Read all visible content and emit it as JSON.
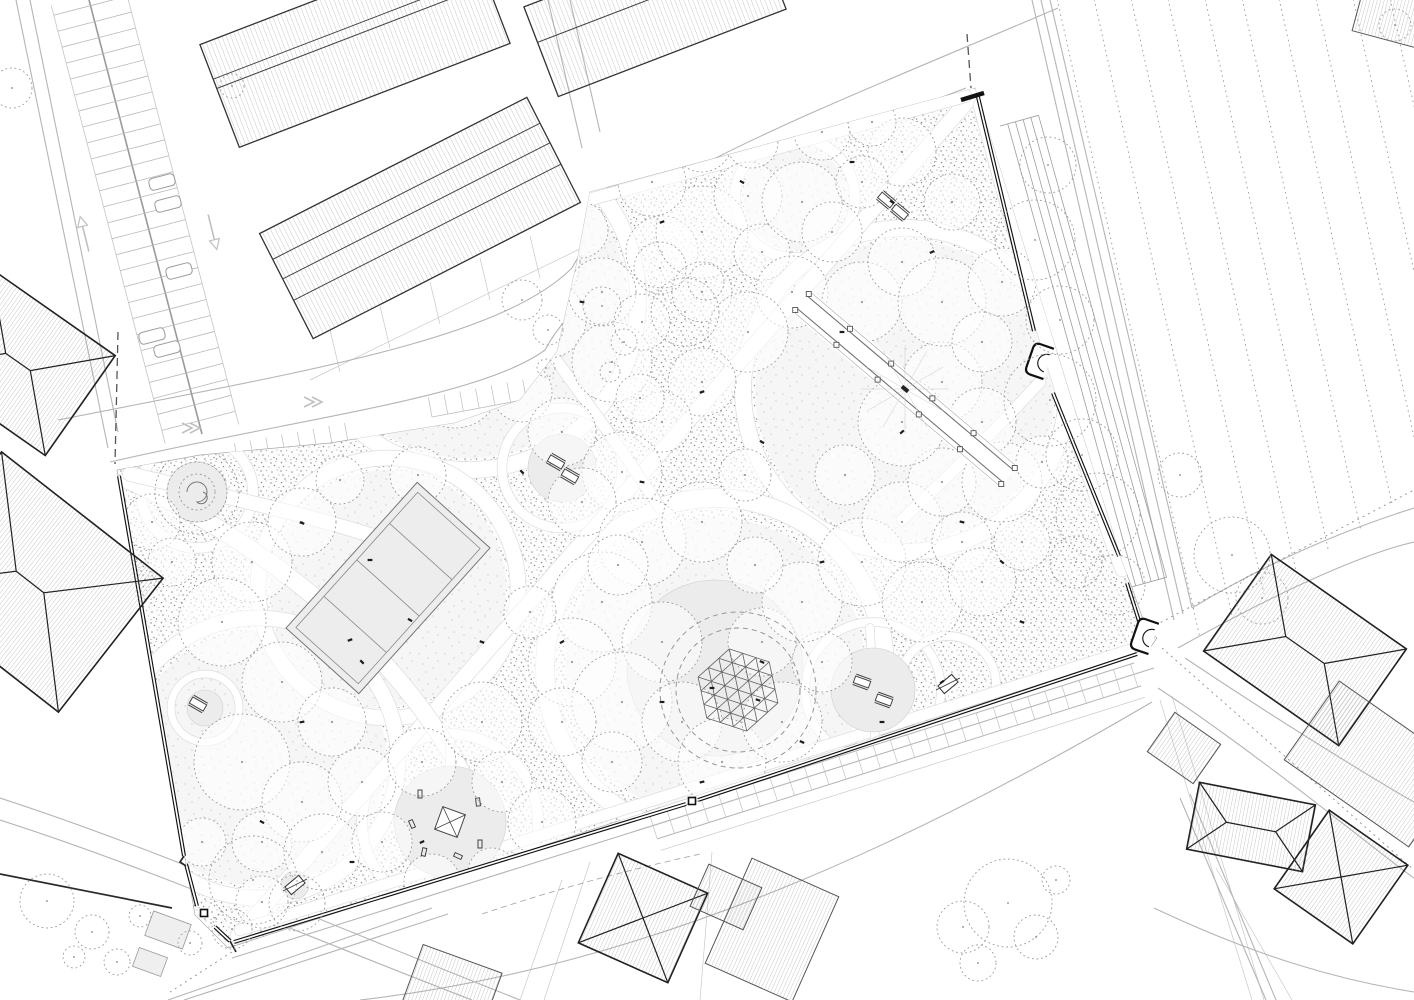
{
  "drawing": {
    "kind": "landscape-site-plan",
    "width": 1414,
    "height": 1000
  },
  "palette": {
    "ink": "#1a1a1a",
    "line": "#8a8a8a",
    "faint": "#c9c9c9",
    "road": "#b5b5b5",
    "stipple_dot": "#8c8c8c",
    "stipple_dot_light": "#b9b9b9",
    "clearing": "#f6f6f6",
    "lawn": "#ececec",
    "court": "#ededed",
    "white": "#ffffff",
    "wall": "#111111",
    "roof_hatch": "#8f8f8f",
    "tree": "#909090"
  },
  "park": {
    "boundary": [
      [
        590,
        192
      ],
      [
        975,
        88
      ],
      [
        1122,
        562
      ],
      [
        1131,
        585
      ],
      [
        1146,
        628
      ],
      [
        1157,
        638
      ],
      [
        1150,
        648
      ],
      [
        228,
        948
      ],
      [
        195,
        915
      ],
      [
        117,
        470
      ],
      [
        200,
        455
      ],
      [
        330,
        443
      ],
      [
        455,
        423
      ],
      [
        520,
        400
      ],
      [
        557,
        352
      ],
      [
        577,
        262
      ]
    ],
    "walls": [
      "M 978,97 L 1034,331",
      "M 1053,393 L 1119,556",
      "M 1127,583 L 1139,621",
      "M 1137,654 L 698,800",
      "M 686,804 L 234,942",
      "M 119,476 L 184,856",
      "M 186,864 L 197,906",
      "M 215,927 L 230,941"
    ],
    "thin_walls": [
      "M 0,874 L 172,908",
      "M 230,941 L 236,952",
      "M 184,856 L 180,862 L 186,866"
    ],
    "gate_bar": "M 961,100 L 984,93",
    "pillars": [
      [
        204,
        913
      ],
      [
        692,
        801
      ]
    ],
    "alcoves": [
      [
        1043,
        362,
        -71
      ],
      [
        1148,
        637,
        -71
      ]
    ]
  },
  "clearings": [
    [
      468,
      300,
      158
    ],
    [
      795,
      198,
      52
    ],
    [
      905,
      390,
      150
    ],
    [
      388,
      588,
      118
    ],
    [
      715,
      668,
      150
    ],
    [
      258,
      758,
      128
    ]
  ],
  "rings": [
    [
      468,
      300,
      170,
      16
    ],
    [
      795,
      198,
      60,
      10
    ],
    [
      905,
      390,
      162,
      16
    ],
    [
      388,
      588,
      130,
      15
    ],
    [
      715,
      668,
      170,
      18
    ],
    [
      258,
      758,
      140,
      15
    ],
    [
      450,
      822,
      88,
      10
    ],
    [
      562,
      468,
      60,
      9
    ],
    [
      873,
      690,
      68,
      8
    ],
    [
      948,
      684,
      48,
      8
    ],
    [
      197,
      492,
      56,
      10
    ],
    [
      205,
      708,
      34,
      7
    ]
  ],
  "lawn_discs": [
    [
      715,
      668,
      88
    ],
    [
      450,
      822,
      56
    ],
    [
      873,
      690,
      42
    ],
    [
      562,
      468,
      34
    ],
    [
      197,
      492,
      30
    ],
    [
      205,
      708,
      18
    ],
    [
      295,
      885,
      14
    ]
  ],
  "paths": [
    {
      "d": "M 238,936 L 972,96",
      "w": 15
    },
    {
      "d": "M 128,480 C 300,560 420,680 470,790 C 496,846 540,868 622,856",
      "w": 17
    },
    {
      "d": "M 130,474 C 240,500 330,520 400,545",
      "w": 14
    },
    {
      "d": "M 980,105 C 1010,220 1070,430 1122,570",
      "w": 13
    },
    {
      "d": "M 240,930 L 1130,650",
      "w": 11
    },
    {
      "d": "M 588,200 L 966,96",
      "w": 12
    },
    {
      "d": "M 556,360 C 600,420 636,470 660,508",
      "w": 11
    },
    {
      "d": "M 1040,382 C 986,440 942,482 902,520",
      "w": 11
    },
    {
      "d": "M 450,742 L 452,940",
      "w": 9
    },
    {
      "d": "M 870,628 L 876,760",
      "w": 8
    },
    {
      "d": "M 700,826 C 760,800 820,770 880,740",
      "w": 9
    }
  ],
  "trees": [
    [
      400,
      240,
      55
    ],
    [
      470,
      215,
      42
    ],
    [
      532,
      262,
      48
    ],
    [
      428,
      302,
      36
    ],
    [
      492,
      322,
      50
    ],
    [
      548,
      320,
      38
    ],
    [
      390,
      348,
      42
    ],
    [
      455,
      382,
      46
    ],
    [
      522,
      392,
      30
    ],
    [
      350,
      300,
      30
    ],
    [
      562,
      432,
      34
    ],
    [
      612,
      362,
      40
    ],
    [
      602,
      292,
      34
    ],
    [
      642,
      322,
      28
    ],
    [
      662,
      252,
      36
    ],
    [
      702,
      232,
      46
    ],
    [
      748,
      196,
      34
    ],
    [
      702,
      292,
      30
    ],
    [
      762,
      252,
      28
    ],
    [
      802,
      202,
      40
    ],
    [
      832,
      232,
      30
    ],
    [
      792,
      292,
      36
    ],
    [
      748,
      332,
      40
    ],
    [
      702,
      382,
      34
    ],
    [
      662,
      422,
      30
    ],
    [
      622,
      472,
      40
    ],
    [
      582,
      502,
      34
    ],
    [
      642,
      542,
      44
    ],
    [
      702,
      522,
      40
    ],
    [
      602,
      602,
      50
    ],
    [
      662,
      642,
      40
    ],
    [
      572,
      662,
      44
    ],
    [
      622,
      702,
      50
    ],
    [
      682,
      722,
      40
    ],
    [
      562,
      722,
      34
    ],
    [
      612,
      762,
      30
    ],
    [
      722,
      762,
      44
    ],
    [
      782,
      722,
      40
    ],
    [
      762,
      642,
      34
    ],
    [
      822,
      662,
      30
    ],
    [
      802,
      602,
      40
    ],
    [
      862,
      562,
      44
    ],
    [
      902,
      522,
      40
    ],
    [
      942,
      482,
      34
    ],
    [
      962,
      542,
      30
    ],
    [
      922,
      602,
      40
    ],
    [
      982,
      582,
      34
    ],
    [
      1022,
      542,
      28
    ],
    [
      1002,
      482,
      40
    ],
    [
      1042,
      462,
      26
    ],
    [
      902,
      422,
      44
    ],
    [
      942,
      382,
      40
    ],
    [
      982,
      422,
      34
    ],
    [
      862,
      302,
      40
    ],
    [
      902,
      262,
      34
    ],
    [
      942,
      302,
      44
    ],
    [
      982,
      342,
      30
    ],
    [
      1002,
      282,
      34
    ],
    [
      952,
      202,
      28
    ],
    [
      902,
      152,
      34
    ],
    [
      862,
      182,
      26
    ],
    [
      252,
      562,
      40
    ],
    [
      302,
      522,
      34
    ],
    [
      222,
      622,
      44
    ],
    [
      282,
      682,
      40
    ],
    [
      332,
      722,
      34
    ],
    [
      242,
      762,
      48
    ],
    [
      302,
      802,
      40
    ],
    [
      362,
      782,
      34
    ],
    [
      262,
      842,
      30
    ],
    [
      322,
      852,
      38
    ],
    [
      382,
      842,
      30
    ],
    [
      422,
      762,
      34
    ],
    [
      482,
      722,
      40
    ],
    [
      502,
      782,
      30
    ],
    [
      542,
      822,
      34
    ],
    [
      152,
      522,
      28
    ],
    [
      172,
      562,
      24
    ],
    [
      202,
      842,
      24
    ],
    [
      262,
      902,
      26
    ],
    [
      432,
      882,
      28
    ],
    [
      492,
      872,
      24
    ],
    [
      702,
      142,
      30
    ],
    [
      652,
      182,
      34
    ],
    [
      752,
      142,
      26
    ],
    [
      822,
      132,
      28
    ],
    [
      872,
      122,
      24
    ],
    [
      618,
      565,
      30
    ],
    [
      530,
      612,
      26
    ],
    [
      418,
      475,
      28
    ],
    [
      340,
      480,
      24
    ],
    [
      640,
      398,
      24
    ],
    [
      580,
      230,
      28
    ],
    [
      755,
      565,
      28
    ],
    [
      845,
      475,
      30
    ],
    [
      745,
      475,
      26
    ]
  ],
  "outer_trees": [
    [
      1048,
      165,
      28
    ],
    [
      1035,
      240,
      40
    ],
    [
      1060,
      320,
      34
    ],
    [
      1050,
      400,
      46
    ],
    [
      1082,
      455,
      36
    ],
    [
      1098,
      515,
      42
    ],
    [
      1076,
      562,
      26
    ],
    [
      1115,
      585,
      30
    ],
    [
      1232,
      555,
      38
    ],
    [
      1262,
      598,
      26
    ],
    [
      1180,
      475,
      22
    ],
    [
      963,
      927,
      26
    ],
    [
      1008,
      903,
      44
    ],
    [
      1036,
      937,
      22
    ],
    [
      1056,
      880,
      14
    ],
    [
      978,
      963,
      18
    ],
    [
      47,
      901,
      27
    ],
    [
      92,
      932,
      17
    ],
    [
      117,
      962,
      13
    ],
    [
      74,
      957,
      11
    ],
    [
      140,
      916,
      11
    ],
    [
      253,
      880,
      44
    ],
    [
      297,
      903,
      28
    ],
    [
      232,
      929,
      20
    ],
    [
      190,
      943,
      12
    ],
    [
      12,
      88,
      20
    ],
    [
      232,
      86,
      12
    ],
    [
      660,
      268,
      26
    ],
    [
      685,
      312,
      34
    ],
    [
      706,
      282,
      18
    ],
    [
      522,
      300,
      20
    ],
    [
      548,
      330,
      15
    ],
    [
      602,
      306,
      19
    ],
    [
      624,
      342,
      13
    ],
    [
      546,
      368,
      9
    ],
    [
      610,
      372,
      10
    ],
    [
      1395,
      25,
      16
    ]
  ],
  "benches": [
    [
      302,
      523,
      20
    ],
    [
      422,
      362,
      -30
    ],
    [
      522,
      472,
      45
    ],
    [
      642,
      482,
      10
    ],
    [
      702,
      392,
      -20
    ],
    [
      762,
      442,
      30
    ],
    [
      842,
      332,
      0
    ],
    [
      902,
      432,
      -40
    ],
    [
      962,
      522,
      15
    ],
    [
      1002,
      562,
      40
    ],
    [
      822,
      562,
      -15
    ],
    [
      762,
      662,
      25
    ],
    [
      662,
      702,
      0
    ],
    [
      562,
      642,
      -30
    ],
    [
      482,
      642,
      20
    ],
    [
      362,
      662,
      45
    ],
    [
      302,
      722,
      -10
    ],
    [
      262,
      822,
      30
    ],
    [
      352,
      862,
      0
    ],
    [
      422,
      842,
      -25
    ],
    [
      562,
      842,
      15
    ],
    [
      642,
      822,
      40
    ],
    [
      702,
      782,
      -15
    ],
    [
      802,
      742,
      25
    ],
    [
      882,
      722,
      0
    ],
    [
      942,
      682,
      -35
    ],
    [
      1022,
      622,
      20
    ],
    [
      582,
      302,
      10
    ],
    [
      662,
      222,
      -20
    ],
    [
      742,
      182,
      30
    ],
    [
      852,
      162,
      0
    ],
    [
      932,
      252,
      -25
    ],
    [
      462,
      902,
      15
    ],
    [
      892,
      202,
      35
    ],
    [
      712,
      688,
      0
    ],
    [
      758,
      700,
      18
    ],
    [
      370,
      560,
      0
    ],
    [
      410,
      620,
      30
    ],
    [
      350,
      640,
      -20
    ]
  ],
  "court": {
    "c": [
      388,
      588
    ],
    "w": 196,
    "h": 98,
    "a": -48
  },
  "dome": {
    "c": [
      738,
      690
    ],
    "R": 42,
    "a": 18,
    "rings": [
      62,
      78
    ]
  },
  "pergola": {
    "a": [
      802,
      302
    ],
    "b": [
      1008,
      476
    ]
  },
  "mound": {
    "c": [
      197,
      492
    ],
    "rings": [
      18,
      30,
      42
    ]
  },
  "playgrounds": [
    {
      "c": [
        450,
        822
      ],
      "r": 56,
      "icon": "square"
    },
    {
      "c": [
        873,
        690
      ],
      "r": 42,
      "icon": "tables"
    },
    {
      "c": [
        948,
        684
      ],
      "r": 30,
      "icon": "swing"
    },
    {
      "c": [
        562,
        468
      ],
      "r": 34,
      "icon": "tables"
    },
    {
      "c": [
        205,
        708
      ],
      "r": 18,
      "icon": "tables"
    },
    {
      "c": [
        295,
        885
      ],
      "r": 14,
      "icon": "swing"
    }
  ],
  "tables": [
    [
      886,
      200,
      40
    ],
    [
      900,
      212,
      40
    ],
    [
      556,
      462,
      30
    ],
    [
      570,
      476,
      30
    ],
    [
      862,
      682,
      20
    ],
    [
      884,
      700,
      20
    ],
    [
      198,
      704,
      30
    ]
  ],
  "industrial_buildings": [
    {
      "c": [
        355,
        44
      ],
      "w": 290,
      "h": 110,
      "a": -21,
      "ridges": [
        -18,
        -8
      ]
    },
    {
      "c": [
        420,
        218
      ],
      "w": 300,
      "h": 118,
      "a": -27,
      "ridges": [
        -30,
        -8,
        16
      ]
    },
    {
      "c": [
        655,
        8
      ],
      "w": 244,
      "h": 96,
      "a": -21,
      "ridges": [
        -10
      ]
    }
  ],
  "houses": [
    {
      "c": [
        18,
        362
      ],
      "w": 152,
      "h": 122,
      "a": 35,
      "t": "hip"
    },
    {
      "c": [
        30,
        582
      ],
      "w": 205,
      "h": 170,
      "a": 38,
      "t": "hip"
    },
    {
      "c": [
        643,
        918
      ],
      "w": 98,
      "h": 98,
      "a": 24,
      "t": "hip"
    },
    {
      "c": [
        772,
        930
      ],
      "w": 95,
      "h": 115,
      "a": 24,
      "t": "flat"
    },
    {
      "c": [
        726,
        897
      ],
      "w": 58,
      "h": 46,
      "a": 24,
      "t": "flat"
    },
    {
      "c": [
        1305,
        650
      ],
      "w": 165,
      "h": 118,
      "a": 35,
      "t": "hip"
    },
    {
      "c": [
        1374,
        764
      ],
      "w": 152,
      "h": 96,
      "a": 35,
      "t": "flat"
    },
    {
      "c": [
        1184,
        748
      ],
      "w": 56,
      "h": 48,
      "a": 35,
      "t": "flat"
    },
    {
      "c": [
        1251,
        827
      ],
      "w": 118,
      "h": 68,
      "a": 11,
      "t": "hip"
    },
    {
      "c": [
        1341,
        877
      ],
      "w": 96,
      "h": 96,
      "a": 35,
      "t": "hip"
    },
    {
      "c": [
        1398,
        14
      ],
      "w": 80,
      "h": 56,
      "a": 15,
      "t": "flat"
    },
    {
      "c": [
        452,
        988
      ],
      "w": 84,
      "h": 62,
      "a": 20,
      "t": "flat"
    }
  ],
  "sheds": [
    [
      168,
      930,
      40,
      26,
      20
    ],
    [
      150,
      962,
      30,
      20,
      20
    ]
  ],
  "parking_main": {
    "a": [
      88,
      -4
    ],
    "b": [
      202,
      434
    ],
    "half": 52,
    "stall": 38,
    "step": 16.5
  },
  "cars": [
    [
      162,
      182
    ],
    [
      168,
      204
    ],
    [
      179,
      271
    ],
    [
      152,
      336
    ],
    [
      167,
      349
    ]
  ],
  "stall_rows": [
    {
      "a": [
        238,
        463
      ],
      "b": [
        352,
        442
      ],
      "depth": 20,
      "step": 16
    },
    {
      "a": [
        432,
        417
      ],
      "b": [
        608,
        384
      ],
      "depth": 20,
      "step": 16
    }
  ],
  "ladder_south": {
    "a": [
      650,
      816
    ],
    "b": [
      1134,
      663
    ],
    "off": 24,
    "off2": 36,
    "step": 18
  },
  "field": {
    "x0": 1056,
    "y0": -6,
    "step": 37,
    "count": 10,
    "dir": [
      0.218,
      0.975
    ],
    "len": 660,
    "clip": [
      [
        1028,
        -6
      ],
      [
        1414,
        -6
      ],
      [
        1414,
        492
      ],
      [
        1196,
        640
      ],
      [
        1176,
        622
      ]
    ]
  },
  "hedges": {
    "p1": [
      1000,
      126
    ],
    "p2": [
      1128,
      588
    ],
    "offsets": [
      8,
      16,
      24,
      32,
      40
    ]
  },
  "roads": [
    "M 58,420 C 300,372 500,340 572,268 C 612,188 800,118 1058,8",
    "M 110,462 C 300,418 480,398 545,350 C 588,268 760,165 966,88",
    "M 30,0 L 118,432",
    "M 16,0 L 108,448",
    "M 548,0 L 582,148",
    "M 570,0 L 600,132",
    "M 1032,0 L 1174,620",
    "M 1041,0 L 1183,614",
    "M 1050,0 L 1192,608",
    "M 1192,608 C 1280,555 1360,525 1414,508",
    "M 1178,648 C 1290,585 1370,552 1414,542",
    "M 1185,658 C 1300,735 1396,792 1414,802",
    "M 1158,688 C 1260,755 1390,862 1414,878",
    "M 360,1000 C 640,968 900,850 1152,702",
    "M 232,958 L 1154,668",
    "M 0,798 C 160,850 330,925 520,1000",
    "M 0,820 C 150,868 300,934 472,1000",
    "M 168,1000 L 432,908",
    "M 184,1000 L 448,914",
    "M 1180,798 L 1266,1000",
    "M 1190,794 L 1276,1000",
    "M 1154,908 C 1260,958 1340,980 1414,992"
  ],
  "faint_lines": [
    "M 310,380 L 586,246",
    "M 330,330 L 340,372",
    "M 380,306 L 390,348",
    "M 430,282 L 440,324",
    "M 480,258 L 490,300",
    "M 530,236 L 540,278",
    "M 590,862 L 544,1000",
    "M 712,852 L 700,1000",
    "M 520,1000 L 562,880",
    "M 1160,700 L 1252,1000",
    "M 1172,696 L 1264,1000",
    "M 1216,868 L 1292,1000"
  ],
  "dashed_lines": [
    {
      "d": "M 1162,648 L 1414,870",
      "da": "2 4",
      "w": 1,
      "c": "#999999"
    },
    {
      "d": "M 1150,628 L 1414,490",
      "da": "2 4",
      "w": 1,
      "c": "#999999"
    },
    {
      "d": "M 118,332 L 115,464",
      "da": "8 5",
      "w": 1.3,
      "c": "#555555"
    },
    {
      "d": "M 967,34 L 971,88",
      "da": "8 5",
      "w": 1.3,
      "c": "#555555"
    },
    {
      "d": "M 482,914 C 560,888 620,872 700,854",
      "da": "6 4",
      "w": 0.9,
      "c": "#aaaaaa"
    },
    {
      "d": "M 232,952 L 170,992",
      "da": "2 4",
      "w": 1,
      "c": "#999999"
    }
  ],
  "arrows": [
    {
      "p": [
        85,
        236
      ],
      "a": -104,
      "t": "line"
    },
    {
      "p": [
        212,
        230
      ],
      "a": 76,
      "t": "line"
    },
    {
      "p": [
        196,
        428
      ],
      "a": 180,
      "t": "chev"
    },
    {
      "p": [
        250,
        474
      ],
      "a": 0,
      "t": "chev"
    },
    {
      "p": [
        318,
        402
      ],
      "a": 180,
      "t": "chev"
    },
    {
      "p": [
        640,
        372
      ],
      "a": 0,
      "t": "chev"
    }
  ]
}
